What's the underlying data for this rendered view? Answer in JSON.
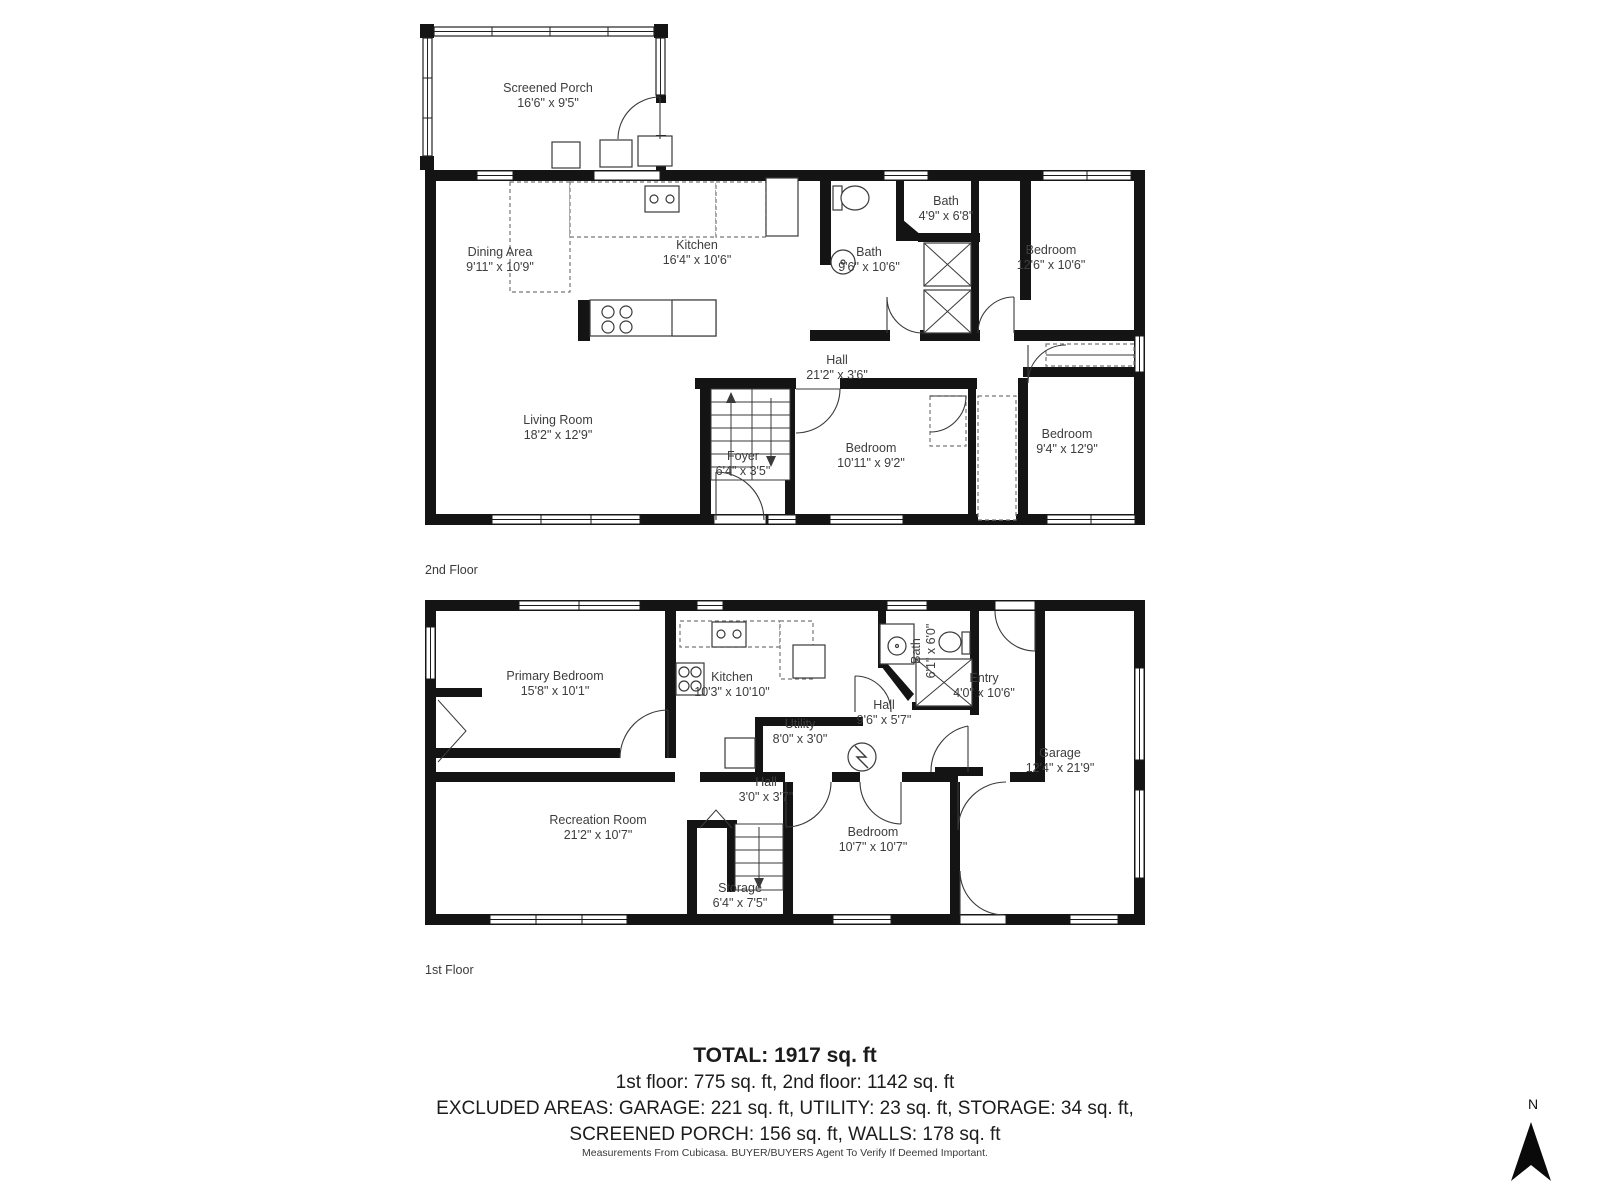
{
  "floors": [
    {
      "label": "2nd Floor",
      "rooms": [
        {
          "name": "Screened Porch",
          "dims": "16'6\" x 9'5\""
        },
        {
          "name": "Dining Area",
          "dims": "9'11\" x 10'9\""
        },
        {
          "name": "Kitchen",
          "dims": "16'4\" x 10'6\""
        },
        {
          "name": "Bath",
          "dims": "4'9\" x 6'8\""
        },
        {
          "name": "Bath",
          "dims": "9'6\" x 10'6\""
        },
        {
          "name": "Bedroom",
          "dims": "12'6\" x 10'6\""
        },
        {
          "name": "Hall",
          "dims": "21'2\" x 3'6\""
        },
        {
          "name": "Living Room",
          "dims": "18'2\" x 12'9\""
        },
        {
          "name": "Foyer",
          "dims": "6'4\" x 3'5\""
        },
        {
          "name": "Bedroom",
          "dims": "10'11\" x 9'2\""
        },
        {
          "name": "Bedroom",
          "dims": "9'4\" x 12'9\""
        }
      ]
    },
    {
      "label": "1st Floor",
      "rooms": [
        {
          "name": "Primary Bedroom",
          "dims": "15'8\" x 10'1\""
        },
        {
          "name": "Kitchen",
          "dims": "10'3\" x 10'10\""
        },
        {
          "name": "Bath",
          "dims": "6'1\" x 6'0\""
        },
        {
          "name": "Entry",
          "dims": "4'0\" x 10'6\""
        },
        {
          "name": "Utility",
          "dims": "8'0\" x 3'0\""
        },
        {
          "name": "Hall",
          "dims": "9'6\" x 5'7\""
        },
        {
          "name": "Garage",
          "dims": "12'4\" x 21'9\""
        },
        {
          "name": "Recreation Room",
          "dims": "21'2\" x 10'7\""
        },
        {
          "name": "Hall",
          "dims": "3'0\" x 3'7\""
        },
        {
          "name": "Bedroom",
          "dims": "10'7\" x 10'7\""
        },
        {
          "name": "Storage",
          "dims": "6'4\" x 7'5\""
        }
      ]
    }
  ],
  "summary": {
    "total": "TOTAL: 1917 sq. ft",
    "line2": "1st floor: 775 sq. ft, 2nd floor: 1142 sq. ft",
    "line3": "EXCLUDED AREAS: GARAGE: 221 sq. ft, UTILITY: 23 sq. ft, STORAGE: 34 sq. ft,",
    "line4": "SCREENED PORCH: 156 sq. ft, WALLS: 178 sq. ft"
  },
  "disclaimer": "Measurements From Cubicasa. BUYER/BUYERS Agent To Verify If Deemed Important.",
  "compass": {
    "label": "N"
  },
  "colors": {
    "wall": "#141414",
    "text": "#3d3d3d"
  }
}
